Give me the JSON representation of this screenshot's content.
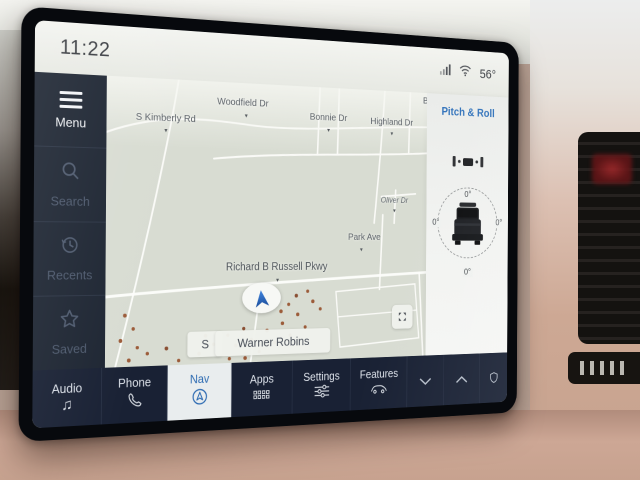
{
  "status_bar": {
    "clock": "11:22",
    "temperature": "56°",
    "icons": [
      "cellular-signal-icon",
      "wifi-icon"
    ]
  },
  "sidebar": {
    "items": [
      {
        "label": "Menu",
        "icon": "hamburger-icon",
        "active": true
      },
      {
        "label": "Search",
        "icon": "search-icon",
        "active": false
      },
      {
        "label": "Recents",
        "icon": "recents-clock-icon",
        "active": false
      },
      {
        "label": "Saved",
        "icon": "star-icon",
        "active": false
      }
    ]
  },
  "map": {
    "streets": [
      {
        "name": "Woodfield Dr"
      },
      {
        "name": "S Kimberly Rd"
      },
      {
        "name": "Bonnie Dr"
      },
      {
        "name": "Highland Dr"
      },
      {
        "name": "Oliver Dr"
      },
      {
        "name": "Park Ave"
      },
      {
        "name": "Richard B Russell Pkwy"
      },
      {
        "name": "B"
      }
    ],
    "city_label": "Warner Robins",
    "compass": "S",
    "marker_icon": "vehicle-location-arrow",
    "recenter_icon": "expand-arrows-icon"
  },
  "pitch_roll": {
    "title": "Pitch & Roll",
    "pitch_front": "0°",
    "roll_left": "0°",
    "roll_right": "0°",
    "pitch_rear": "0°"
  },
  "tab_bar": {
    "tabs": [
      {
        "label": "Audio",
        "icon": "music-note-icon",
        "glyph": "♫",
        "selected": false
      },
      {
        "label": "Phone",
        "icon": "phone-handset-icon",
        "selected": false
      },
      {
        "label": "Nav",
        "icon": "nav-arrow-circle-icon",
        "selected": true
      },
      {
        "label": "Apps",
        "icon": "apps-grid-icon",
        "selected": false
      },
      {
        "label": "Settings",
        "icon": "sliders-icon",
        "selected": false
      },
      {
        "label": "Features",
        "icon": "car-icon",
        "selected": false
      }
    ],
    "extra_icons": [
      "chevron-down-icon",
      "chevron-up-icon",
      "profile-shield-icon"
    ]
  },
  "colors": {
    "accent_blue": "#2d6bb2",
    "sidebar_navy": "#1d2532",
    "tab_bar_navy": "#192134",
    "map_sage": "#d8dcd2",
    "selected_tab_bg": "#e9edee",
    "tree_brown": "#9c5c3a",
    "dash_tan": "#cda795"
  }
}
